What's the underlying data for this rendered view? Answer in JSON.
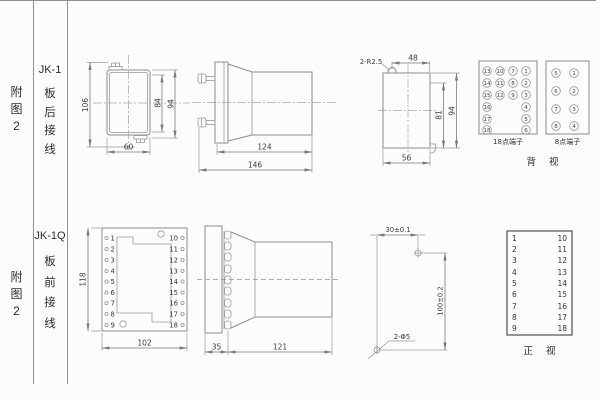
{
  "colors": {
    "bg": "#fcfcfc",
    "drawing_line": "#8d8d8d",
    "dimension_line": "#7a7a7a",
    "text": "#333333",
    "table_border": "#8f8f8f"
  },
  "r1": {
    "ref": [
      "附",
      "图",
      "2"
    ],
    "model": "JK-1",
    "model_chars": [
      "板",
      "后",
      "接",
      "线"
    ],
    "front": {
      "h_total": "106",
      "h_inner": "84",
      "h_outer": "94",
      "w": "60"
    },
    "side": {
      "body": "124",
      "total": "146"
    },
    "rear": {
      "note": "2-R2.5",
      "top": "48",
      "h_inner": "81",
      "h_outer": "94",
      "bottom": "56"
    },
    "t18": {
      "label": "18点端子",
      "c1": [
        "13",
        "14",
        "15",
        "16",
        "17",
        "18"
      ],
      "c2": [
        "10",
        "11",
        "12"
      ],
      "c3": [
        "7",
        "8",
        "9"
      ],
      "c4": [
        "1",
        "2",
        "3",
        "4",
        "5",
        "6"
      ]
    },
    "t8": {
      "label": "8点端子",
      "c1": [
        "5",
        "6",
        "7",
        "8"
      ],
      "c2": [
        "1",
        "2",
        "3",
        "4"
      ]
    },
    "view_label": "背 视"
  },
  "r2": {
    "ref": [
      "附",
      "图",
      "2"
    ],
    "model": "JK-1Q",
    "model_chars": [
      "板",
      "前",
      "接",
      "线"
    ],
    "panel": {
      "left": [
        "1",
        "2",
        "3",
        "4",
        "5",
        "6",
        "7",
        "8",
        "9"
      ],
      "right": [
        "10",
        "11",
        "12",
        "13",
        "14",
        "15",
        "16",
        "17",
        "18"
      ],
      "h": "118",
      "w": "102"
    },
    "side": {
      "flange": "35",
      "body": "121"
    },
    "drill": {
      "h": "30±0.1",
      "v": "100±0.2",
      "holes": "2-Φ5"
    },
    "table": {
      "left": [
        "1",
        "2",
        "3",
        "4",
        "5",
        "6",
        "7",
        "8",
        "9"
      ],
      "right": [
        "10",
        "11",
        "12",
        "13",
        "14",
        "15",
        "16",
        "17",
        "18"
      ],
      "view_label": "正 视"
    }
  }
}
